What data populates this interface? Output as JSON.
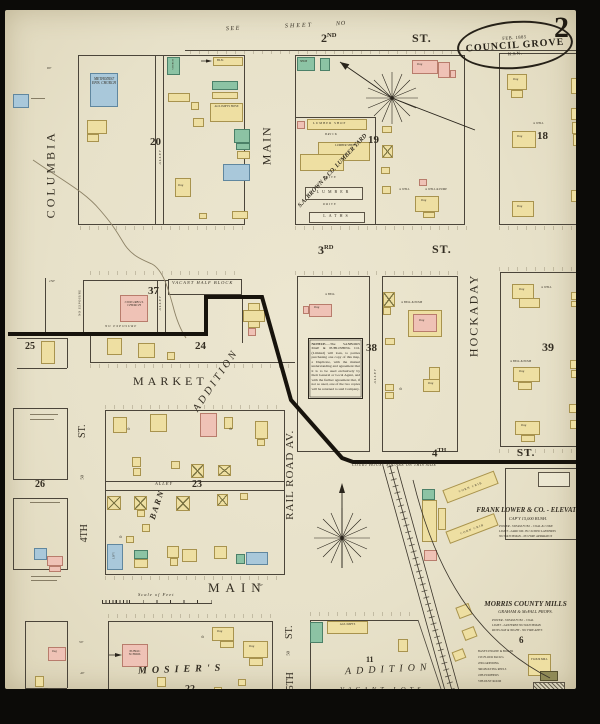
{
  "title": {
    "date": "FEB. 1885",
    "city": "COUNCIL GROVE",
    "state": "KAN.",
    "sheet_number": "2"
  },
  "header": {
    "see": "SEE",
    "sheet": "SHEET",
    "no": "NO"
  },
  "streets": {
    "columbia": "COLUMBIA",
    "main_vertical": "MAIN",
    "main_bottom": "MAIN",
    "hockaday": "HOCKADAY",
    "railroad_av": "RAIL ROAD AV.",
    "market": "MARKET",
    "second_num": "2",
    "second_sup": "ND",
    "third_num": "3",
    "third_sup": "RD",
    "fourth_num": "4",
    "fourth_sup": "TH",
    "fourth_left": "4TH",
    "fifth": "5TH",
    "st": "ST.",
    "fifty": "50"
  },
  "blocks": {
    "b6": "6",
    "b11": "11",
    "b18": "18",
    "b19": "19",
    "b20": "20",
    "b22": "22",
    "b23": "23",
    "b24": "24",
    "b25": "25",
    "b26": "26",
    "b27": "27½",
    "b37": "37",
    "b38": "38",
    "b39": "39"
  },
  "areas": {
    "alley": "ALLEY",
    "barn": "BARN",
    "addition": "ADDITION",
    "mosiers": "MOSIER'S",
    "vacant_lots": "VACANT  LOTS",
    "vacant_half_block": "VACANT HALF BLOCK",
    "no_exposure": "NO EXPOSURE",
    "court_house": "COURT HOUSE SQUARE ON THIS SIDE"
  },
  "buildings": {
    "methodist_church": "METHODIST EPIS. CHURCH",
    "cong_church": "CONG'REG'L CHURCH",
    "public_school": "PUBLIC SCHOOL",
    "church": "CHURCH",
    "shop": "SHOP",
    "blacksmith": "BL'K",
    "agl_house": "AG'L IMP'TS HO'SE",
    "agl_imp": "AG'L IMP'TS",
    "dwg": "Dwg",
    "flour_mill": "FLOUR MILL",
    "corn_crib": "CORN CRIB",
    "lumber_yard": "S.A. BROWN & CO. LUMBER YARD",
    "lumber_shop": "LUMBER SHOP",
    "lumber_shed": "LUMBER SHED",
    "lumber": "LUMBER",
    "laths": "LATHS",
    "brick": "BRICK",
    "drive": "DRIVE",
    "livery": "LIV'Y"
  },
  "features": {
    "well": "WELL",
    "well_pump": "WELL & PUMP",
    "bell": "BELL",
    "bell_pump": "BELL & PUMP",
    "well_icon": "⊙"
  },
  "elevator": {
    "title": "FRANK LOWER & CO. - ELEVATOR",
    "capacity": "CAP'Y 15,000 BUSH.",
    "notes": [
      "POWER - STEAM    FUEL - COAL & COKE",
      "LIGHT - LARD OIL IN CLOSED LANTERNS",
      "NO WATCHMAN  -  NO FIRE APPARATUS"
    ]
  },
  "mills": {
    "title": "MORRIS COUNTY MILLS",
    "props": "GRAHAM & McFALL PROPS.",
    "notes": [
      "POWER - STEAM    FUEL - COAL",
      "LIGHT - LANTERNS    NO WATCHMAN",
      "RUNS DAY & NIGHT - NO FIRE APP'S"
    ],
    "floors": [
      "BASE'T-ENGINE & BOILER",
      "1ST-FLOUR PACK'G",
      "2ND-GRINDING",
      "3RD-BOLTING REELS",
      "4TH-PURIFIERS",
      "5TH-DUST ROOM"
    ]
  },
  "notice": {
    "title": "NOTICE.",
    "body": "—The SANBORN MAP & PUBLISHING CO. (Limited) will loan, to parties purchasing one copy of this map, a Duplicate, with the mutual understanding and agreement that it is to be used exclusively by their General or Local Agent, and with the further agreement that, if not so used, one of the two copies will be returned to said Company."
  },
  "scale": {
    "label": "Scale of Feet"
  },
  "dims": {
    "d150": "150'",
    "d50": "50'",
    "d40": "40'",
    "d80": "80'"
  },
  "colors": {
    "paper": "#e9e3cc",
    "frame_yellow": "#eedfa2",
    "brick_pink": "#efc2b6",
    "special_green": "#8cc3a4",
    "stone_blue": "#a9c8da",
    "ink": "#332d22"
  }
}
